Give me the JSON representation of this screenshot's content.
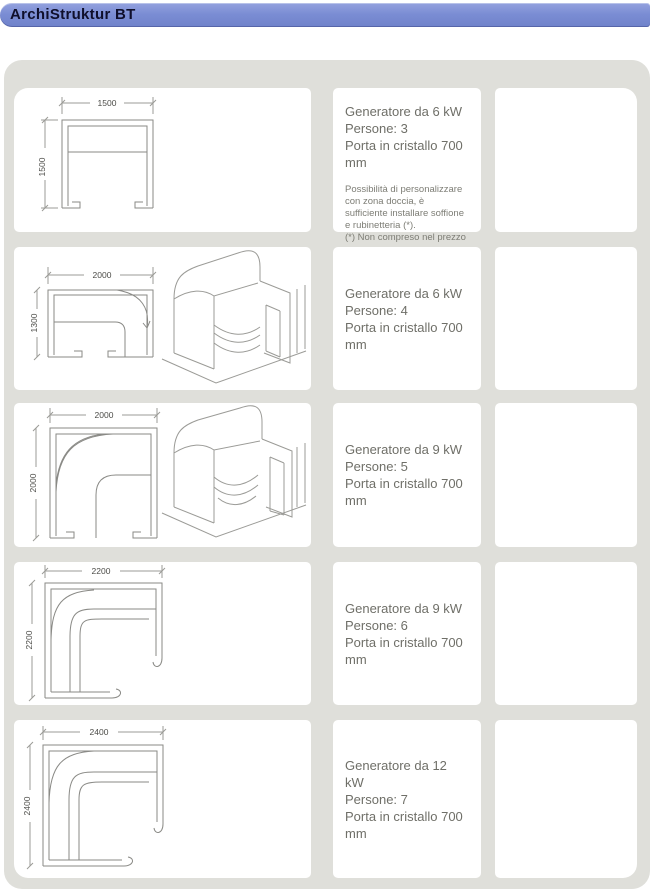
{
  "header": {
    "title": "ArchiStruktur BT"
  },
  "colors": {
    "header_blue": "#7b8dd4",
    "panel_gray": "#dfdfda",
    "cell_white": "#ffffff",
    "spec_text": "#6f6f68",
    "drawing_line": "#8a8a86"
  },
  "rows": [
    {
      "plan": {
        "width_label": "1500",
        "height_label": "1500"
      },
      "specs": [
        "Generatore da 6 kW",
        "Persone: 3",
        "Porta in cristallo 700 mm"
      ],
      "note_lines": [
        "Possibilità di personalizzare con zona doccia, è sufficiente installare soffione e rubinetteria (*).",
        "(*) Non compreso nel prezzo"
      ]
    },
    {
      "plan": {
        "width_label": "2000",
        "height_label": "1300"
      },
      "specs": [
        "Generatore da 6 kW",
        "Persone: 4",
        "Porta in cristallo 700 mm"
      ]
    },
    {
      "plan": {
        "width_label": "2000",
        "height_label": "2000"
      },
      "specs": [
        "Generatore da 9 kW",
        "Persone: 5",
        "Porta in cristallo 700 mm"
      ]
    },
    {
      "plan": {
        "width_label": "2200",
        "height_label": "2200"
      },
      "specs": [
        "Generatore da 9 kW",
        "Persone: 6",
        "Porta in cristallo 700 mm"
      ]
    },
    {
      "plan": {
        "width_label": "2400",
        "height_label": "2400"
      },
      "specs": [
        "Generatore da 12 kW",
        "Persone: 7",
        "Porta in cristallo 700 mm"
      ]
    }
  ]
}
